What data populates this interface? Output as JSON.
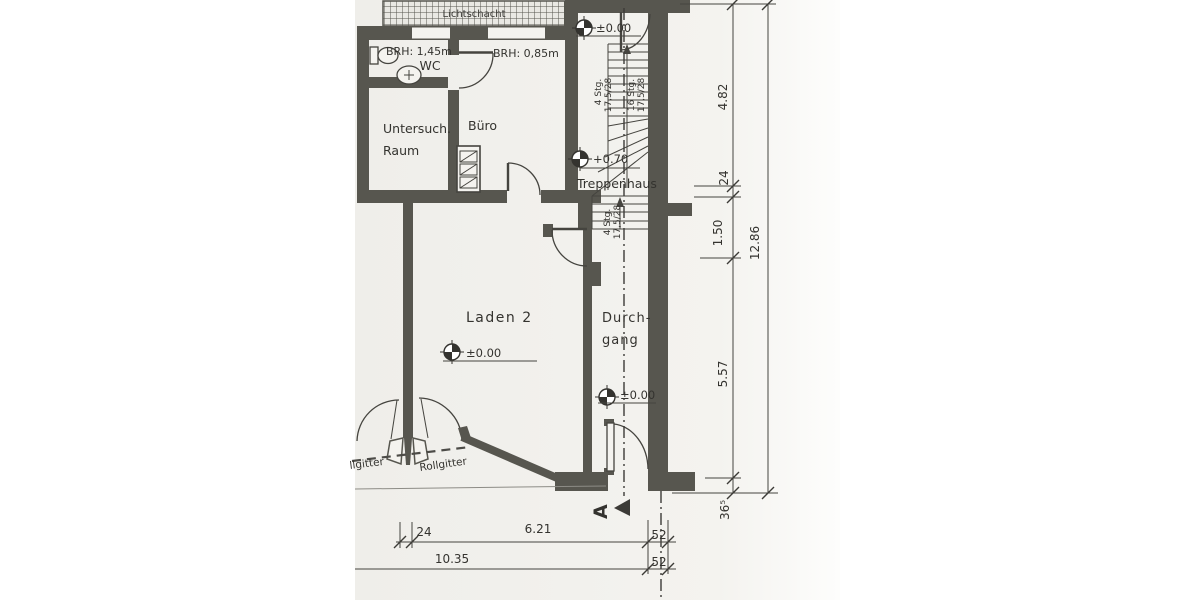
{
  "colors": {
    "wall": "#57564f",
    "linework": "#45443f",
    "text": "#34332f",
    "paper": "#f2f1ed",
    "background": "#ffffff"
  },
  "plan": {
    "lichtschacht": "Lichtschacht",
    "rooms": {
      "wc": "WC",
      "untersuch_line1": "Untersuch.",
      "untersuch_line2": "Raum",
      "buero": "Büro",
      "treppenhaus": "Treppenhaus",
      "laden": "Laden 2",
      "durchgang_line1": "Durch-",
      "durchgang_line2": "gang"
    },
    "labels": {
      "brh_wc": "BRH: 1,45m",
      "brh_buero": "BRH: 0,85m",
      "rollgitter_left": "llgitter",
      "rollgitter_right": "Rollgitter"
    },
    "elevations": {
      "entry": "±0.00",
      "landing": "+0.70",
      "laden": "±0.00",
      "durchgang": "±0.00"
    },
    "stairs": {
      "upper_count": "4 Stg.",
      "upper_ratio": "17,5/28",
      "main_count": "16 Stg.",
      "main_ratio": "17,5/28",
      "lower_count": "4 Stg.",
      "lower_ratio": "17,5/28"
    },
    "section": {
      "label": "A"
    },
    "dimensions": {
      "right": {
        "seg1": "4.82",
        "seg2": "24",
        "seg3": "1.50",
        "seg4": "5.57",
        "seg5": "36⁵",
        "total": "12.86"
      },
      "bottom": {
        "seg1": "24",
        "seg2": "6.21",
        "seg3": "52",
        "total": "10.35",
        "seg4": "52"
      }
    }
  }
}
